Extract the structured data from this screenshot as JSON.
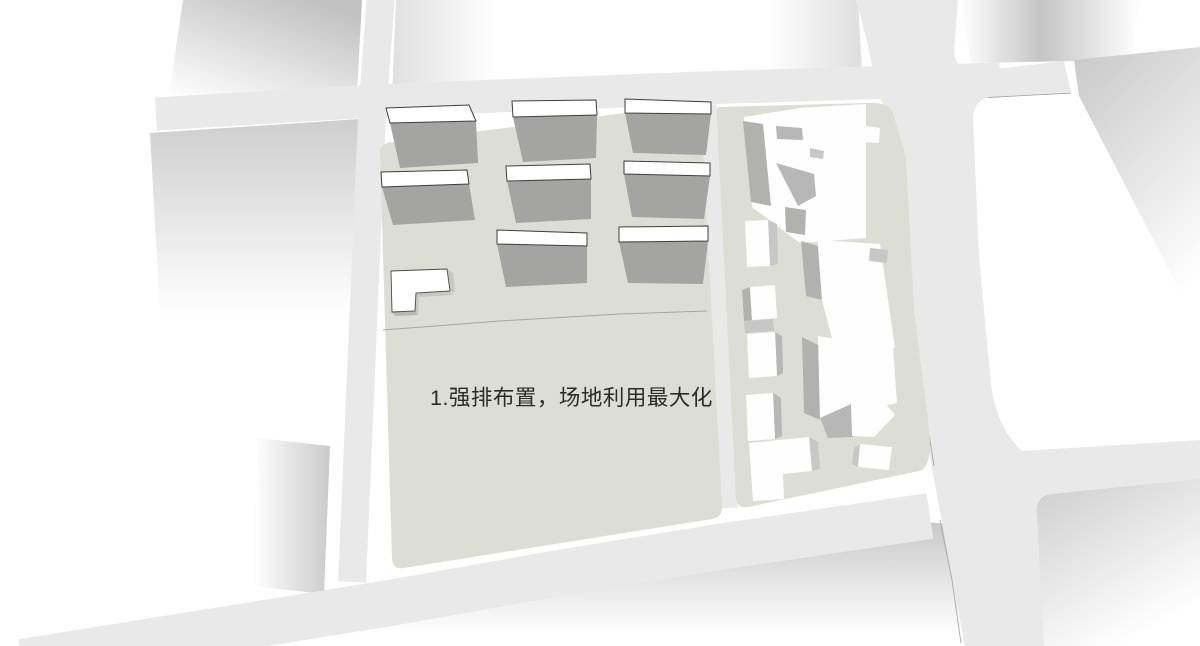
{
  "annotation": {
    "label": "1.强排布置，场地利用最大化"
  },
  "colors": {
    "background": "#ffffff",
    "road": "#e8e9e8",
    "site": "#dcded6",
    "slab_face": "#a4a5a2",
    "roof_white": "#ffffff",
    "roof_outline": "#3e3e3e",
    "white_building": "#fefefe",
    "shade_light": "#c6c7c6",
    "shade_mid": "#b6b7b6",
    "shade_dark": "#b1b2b0",
    "thin_line": "#a8a9a4",
    "text": "#2b2b2b"
  },
  "parcels": {
    "left": {
      "slab_count": 8,
      "small_building_count": 1
    },
    "right": {
      "tower_count": 5,
      "block_count": 3
    }
  }
}
